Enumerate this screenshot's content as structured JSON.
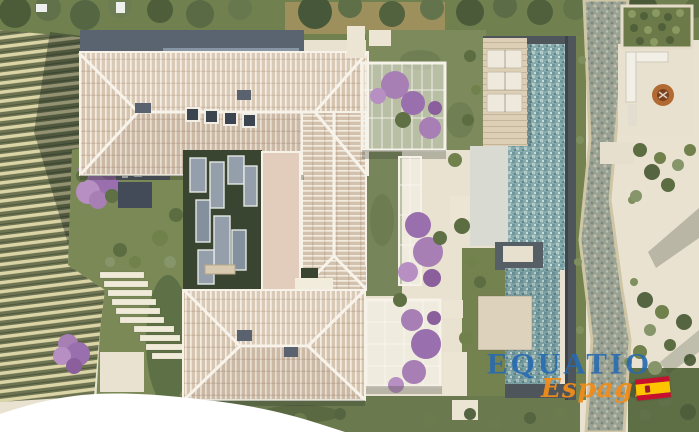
{
  "meta": {
    "type": "aerial-3d-architectural-render",
    "description": "Top-down rendering of a Mediterranean villa estate: two hip tiled roofs joined by a glass-roofed courtyard, long mosaic swimming pool with timber deck and three sun loungers, dry pebble stream, fire-pit lounge terrace, bougainvillea pergolas, vineyard rows on the left and landscaped gardens."
  },
  "watermark": {
    "brand": "EQUATIO",
    "region": "Espagne",
    "brand_color": "#2669b0",
    "region_color": "#f08c1a",
    "flag_icon": "spain-flag-icon",
    "flag_colors": {
      "red": "#c8102e",
      "yellow": "#ffc400"
    }
  },
  "palette": {
    "roof_tile": "#d5c4af",
    "roof_ridge_white": "#f6f2e8",
    "flat_roof_dark": "#5a6470",
    "paving_beige": "#e9e2d1",
    "lawn_green": "#77855a",
    "courtyard_floor": "#3a4531",
    "glass_panel": "#99a4b2",
    "pool_water": "#86a9ab",
    "pool_coping": "#4e565c",
    "deck_wood": "#dccfb5",
    "stream_pebble": "#99a294",
    "vineyard_row_light": "#dbd4a6",
    "vineyard_row_dark": "#6e7452",
    "bougainvillea_purple": "#a77fb5",
    "fire_pit_copper": "#b26a33",
    "margin_white": "#ffffff"
  }
}
